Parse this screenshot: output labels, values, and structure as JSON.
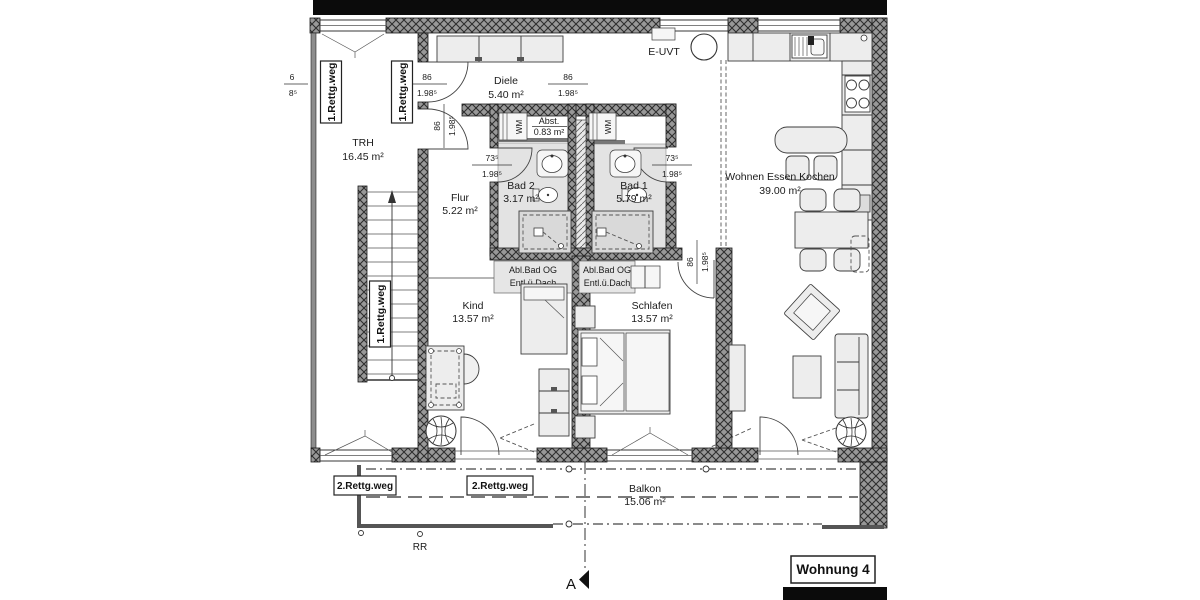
{
  "plan": {
    "title": "Wohnung 4",
    "section_marker": "A",
    "rooms": [
      {
        "name": "TRH",
        "area": "16.45 m²"
      },
      {
        "name": "Diele",
        "area": "5.40 m²"
      },
      {
        "name": "Abst.",
        "area": "0.83 m²"
      },
      {
        "name": "Flur",
        "area": "5.22 m²"
      },
      {
        "name": "Bad 2",
        "area": "3.17 m²"
      },
      {
        "name": "Bad 1",
        "area": "5.79 m²"
      },
      {
        "name": "Wohnen Essen Kochen",
        "area": "39.00 m²"
      },
      {
        "name": "Kind",
        "area": "13.57 m²"
      },
      {
        "name": "Schlafen",
        "area": "13.57 m²"
      },
      {
        "name": "Balkon",
        "area": "15.06 m²"
      }
    ],
    "escape_routes": {
      "first": "1.Rettg.weg",
      "second": "2.Rettg.weg"
    },
    "annotations": {
      "e_uvt": "E-UVT",
      "wm": "WM",
      "rr": "RR",
      "vent_line1": "Abl.Bad OG",
      "vent_line2": "Entl.ü.Dach"
    },
    "dimensions": {
      "d86": "86",
      "d198": "1.98⁵",
      "d735": "73⁵",
      "clip_top": "6",
      "clip_bottom": "8⁵"
    }
  }
}
